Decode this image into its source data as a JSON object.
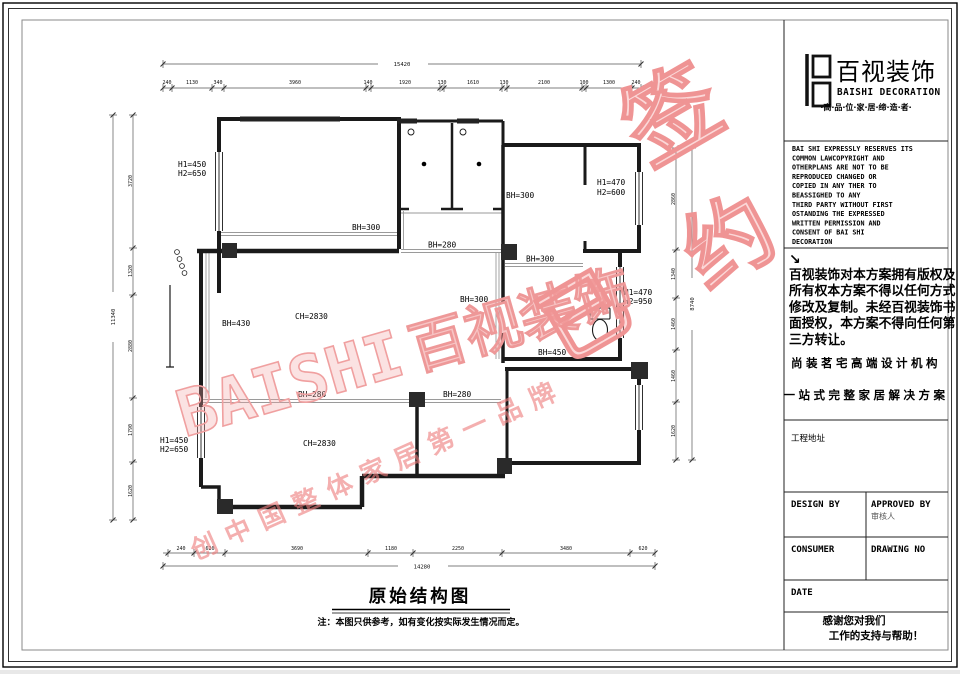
{
  "plan": {
    "title": "原始结构图",
    "note": "注：本图只供参考，如有变化按实际发生情况而定。",
    "labels": {
      "l1a": "H1=450",
      "l1b": "H2=650",
      "l2": "BH=300",
      "l3a": "H1=470",
      "l3b": "H2=600",
      "l4": "BH=300",
      "l5": "BH=280",
      "l6": "BH=300",
      "l7": "BH=300",
      "l8a": "H1=470",
      "l8b": "H2=950",
      "l9": "CH=2830",
      "l10": "BH=430",
      "l11": "BH=450",
      "l12": "BH=280",
      "l13": "BH=280",
      "l14": "CH=2830",
      "l15a": "H1=450",
      "l15b": "H2=650"
    },
    "dims": {
      "top": {
        "total": "15420",
        "segs": [
          "240",
          "1130",
          "340",
          "3960",
          "140",
          "1920",
          "130",
          "1610",
          "130",
          "2100",
          "100",
          "1300",
          "240"
        ]
      },
      "bottom": {
        "total": "14280",
        "segs": [
          "240",
          "620",
          "3690",
          "1180",
          "2250",
          "3480",
          "620"
        ]
      },
      "left": {
        "total": "11340",
        "segs": [
          "3720",
          "1320",
          "2880",
          "1790",
          "1620"
        ]
      },
      "right": {
        "total": "8740",
        "segs": [
          "2860",
          "1340",
          "1460",
          "1460",
          "1620"
        ]
      }
    }
  },
  "watermark": {
    "brand_en": "BAISHI",
    "brand_cn": "百视装饰",
    "stamp_1": "已",
    "stamp_2": "签",
    "stamp_3": "约",
    "sub": "创中国整体家居第一品牌",
    "color": "#ef9a9a"
  },
  "titleblock": {
    "logo_cn": "百视装饰",
    "logo_en": "BAISHI DECORATION",
    "tagline": "·高·品·位·家·居·缔·造·者·",
    "copyright_en_lines": [
      "BAI SHI EXPRESSLY RESERVES ITS",
      "COMMON LAWCOPYRIGHT AND",
      "OTHERPLANS ARE NOT TO BE",
      "REPRODUCED CHANGED OR",
      "COPIED IN ANY THER TO",
      "BEASSIGHED TO ANY",
      "THIRD PARTY    WITHOUT FIRST",
      "OSTANDING THE EXPRESSED",
      "WRITTEN   PERMISSION AND",
      "CONSENT OF    BAI SHI",
      "DECORATION"
    ],
    "arrow": "↘",
    "copyright_cn_lines": [
      "百视装饰对本方案拥有版权及",
      "所有权本方案不得以任何方式",
      "修改及复制。未经百视装饰书",
      "面授权，本方案不得向任何第",
      "三方转让。"
    ],
    "slogan1": "尚装茗宅高端设计机构",
    "slogan2": "一站式完整家居解决方案",
    "address_label": "工程地址",
    "design_by": "DESIGN BY",
    "approved_by": "APPROVED BY",
    "approved_by_cn": "审核人",
    "consumer": "CONSUMER",
    "drawing_no": "DRAWING NO",
    "date_label": "DATE",
    "thanks_lines": [
      "感谢您对我们",
      "工作的支持与帮助！"
    ]
  }
}
